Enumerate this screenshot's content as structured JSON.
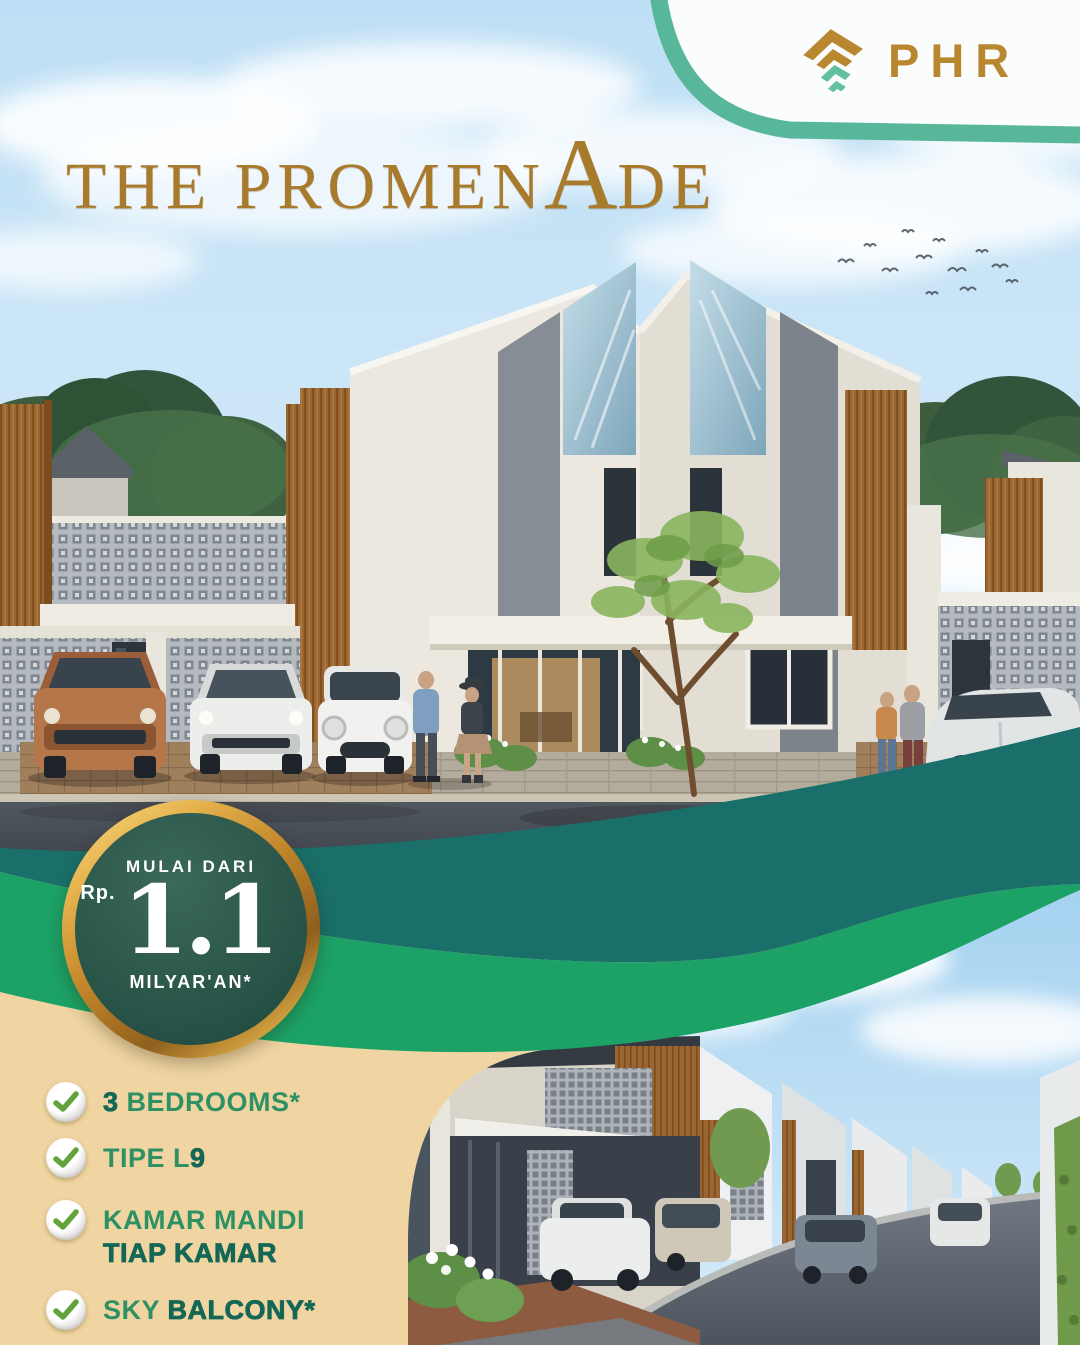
{
  "logo": {
    "text": "PHR",
    "icon": "phr-tree-icon",
    "gold": "#b8872f",
    "teal": "#62bfa0"
  },
  "hero": {
    "title": {
      "lead": "THE PROMEN",
      "big": "A",
      "tail": "DE"
    },
    "title_color": "#a87a2c"
  },
  "badge": {
    "tagline": "MULAI DARI",
    "currency": "Rp.",
    "amount": "1.1",
    "unit": "MILYAR'AN*",
    "ring_color": "#d9a843",
    "fill_color": "#2c584c"
  },
  "features": [
    {
      "s1": "",
      "s2": "3",
      "s3": " BEDROOMS*",
      "line2": ""
    },
    {
      "s1": "TIPE L",
      "s2": "9",
      "s3": "",
      "line2": ""
    },
    {
      "s1": "KAMAR MANDI",
      "s2": "",
      "s3": "",
      "line2": "TIAP KAMAR"
    },
    {
      "s1": "SKY ",
      "s2": "BALCONY*",
      "s3": "",
      "line2": ""
    }
  ],
  "feature_icon": "check-icon",
  "colors": {
    "panel_cream": "#f0d5a2",
    "ribbon_teal": "#1a6f6a",
    "ribbon_green": "#1ca266",
    "feature_green": "#2e9164",
    "feature_dark_green": "#156755",
    "logo_card_arc_teal": "#58b79a",
    "sky_blue": "#c3e2f6"
  }
}
